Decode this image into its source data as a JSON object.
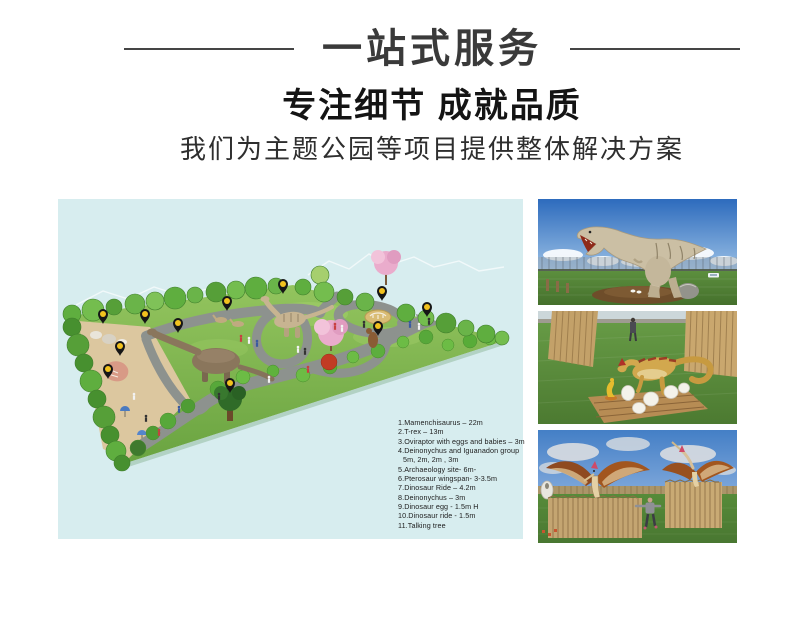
{
  "header": {
    "title": "一站式服务",
    "subtitle": "专注细节 成就品质",
    "tagline": "我们为主题公园等项目提供整体解决方案"
  },
  "illustration": {
    "description": "dinosaur-theme-park-master-plan",
    "background_color": "#d7edef",
    "pin_color": "#f2c21e",
    "pin_count": 11,
    "legend": [
      "1.Mamenchisaurus – 22m",
      "2.T-rex – 13m",
      "3.Oviraptor with eggs and babies – 3m",
      "4.Deinonychus and Iguanadon group",
      "5m, 2m, 2m , 3m",
      "5.Archaeology site- 6m-",
      "6.Pterosaur  wingspan- 3-3.5m",
      "7.Dinosaur Ride – 4.2m",
      "8.Deinonychus – 3m",
      "9.Dinosaur egg - 1.5m H",
      "10.Dinosaur ride -  1.5m",
      "11.Talking tree"
    ]
  },
  "photos": [
    {
      "name": "tyrannosaurus-statue-photo"
    },
    {
      "name": "oviraptor-with-eggs-statue-photo"
    },
    {
      "name": "pterosaur-statues-photo"
    }
  ],
  "colors": {
    "title_text": "#3a3a3a",
    "subtitle_text": "#141414",
    "divider": "#454545",
    "page_background": "#ffffff"
  }
}
